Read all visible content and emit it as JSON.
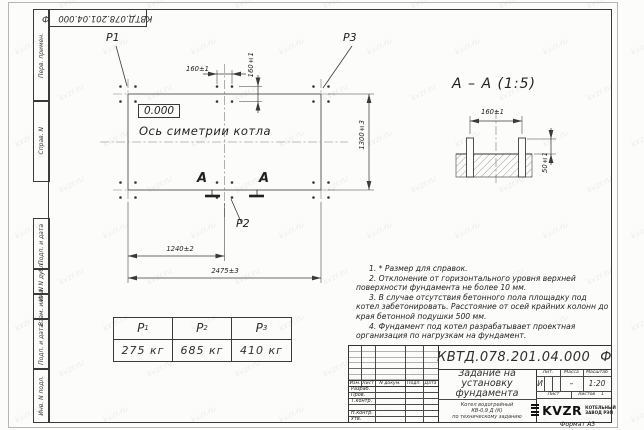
{
  "sheet": {
    "format_label": "Формат А3",
    "watermark_text": "kvzr.ru"
  },
  "corner_stamp": {
    "doc_number": "КВТД.078.201.04.000",
    "suffix": "Ф"
  },
  "side_stamps": {
    "top": [
      "Перв. примен.",
      "Справ. N"
    ],
    "bottom": [
      "Подп. и дата",
      "Инв. N дубл.",
      "Взам. инв. N",
      "Подп. и дата",
      "Инв. N подл."
    ]
  },
  "plan": {
    "p1": "P1",
    "p2": "P2",
    "p3": "P3",
    "elevation": "0.000",
    "axis_label": "Ось симетрии котла",
    "section_letter": "А",
    "dim_bolt_x": "160±1",
    "dim_bolt_y": "160±1",
    "dim_mid": "1240±2",
    "dim_total": "2475±3",
    "dim_depth": "1300±3"
  },
  "section_view": {
    "title": "А – А (1:5)",
    "dim_spacing": "160±1",
    "dim_height": "50±1"
  },
  "notes": [
    "1. * Размер для справок.",
    "2. Отклонение от горизонтального уровня верхней поверхности фундамента не более 10 мм.",
    "3. В случае отсутствия бетонного пола площадку под котел забетонировать. Расстояние от осей крайних колонн до края бетонной подушки 500 мм.",
    "4. Фундамент под котел разрабатывает проектная организация по нагрузкам на фундамент."
  ],
  "load_table": {
    "headers": [
      {
        "base": "Р",
        "sub": "1"
      },
      {
        "base": "Р",
        "sub": "2"
      },
      {
        "base": "Р",
        "sub": "3"
      }
    ],
    "values": [
      "275 кг",
      "685 кг",
      "410 кг"
    ]
  },
  "title_block": {
    "doc_number": "КВТД.078.201.04.000",
    "doc_suffix": "Ф",
    "title_lines": [
      "Задание на",
      "установку",
      "фундамента"
    ],
    "subtitle_lines": [
      "Котел водогрейный",
      "КВ-0,9 Д (К)",
      "по техническому заданию"
    ],
    "rev_header": [
      "Изм.",
      "Лист",
      "N докум.",
      "Подп.",
      "Дата"
    ],
    "sign_rows": [
      "Разраб.",
      "Пров.",
      "Т.контр.",
      "",
      "Н.контр.",
      "Утв."
    ],
    "lit_label": "Лит.",
    "mass_label": "Масса",
    "scale_label": "Масштаб",
    "lit_value": "И",
    "mass_value": "–",
    "scale_value": "1:20",
    "sheet_label": "Лист",
    "sheets_label": "Листов",
    "sheets_value": "1",
    "logo_text": "KVZR",
    "logo_caption": [
      "КОТЕЛЬНЫЙ",
      "ЗАВОД РЭП"
    ]
  }
}
